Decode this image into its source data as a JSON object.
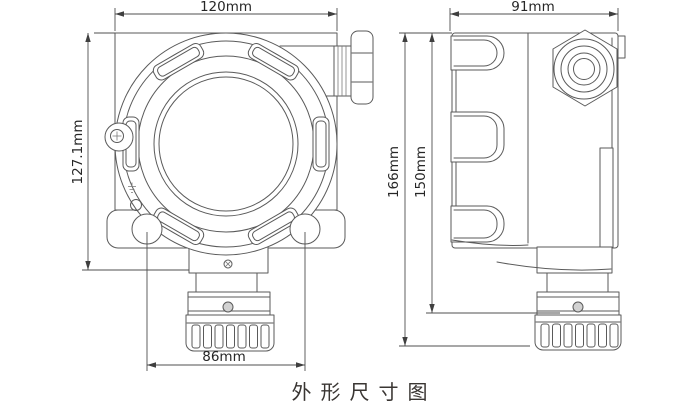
{
  "title": "外形尺寸图",
  "front_view": {
    "dim_width": "120mm",
    "dim_height": "127.1mm",
    "dim_hole_spacing": "86mm"
  },
  "side_view": {
    "dim_width": "91mm",
    "dim_height_overall": "166mm",
    "dim_height_to_cap": "150mm"
  },
  "colors": {
    "background": "#ffffff",
    "line": "#5a5a5a",
    "dimension_text": "#262626",
    "title_text": "#3a3633"
  }
}
